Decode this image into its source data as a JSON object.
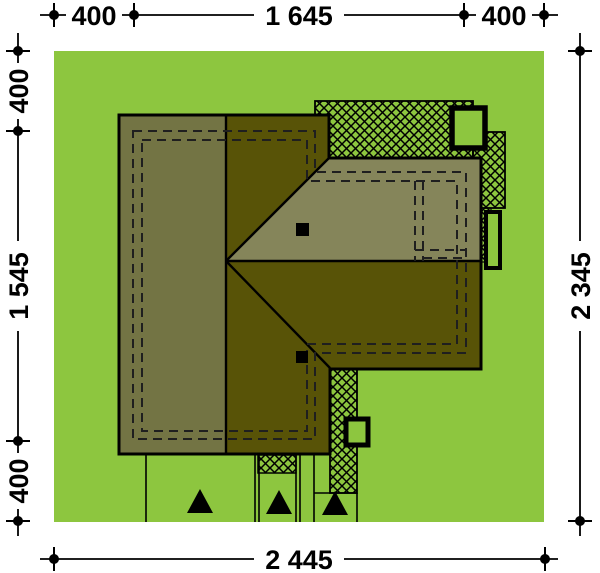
{
  "drawing": {
    "type": "house-site-plan",
    "dimensions": {
      "top": [
        "400",
        "1 645",
        "400"
      ],
      "left": [
        "400",
        "1 545",
        "400"
      ],
      "right": "2 345",
      "bottom": "2 445"
    },
    "colors": {
      "page": "#ffffff",
      "plot_green": "#8dc63f",
      "roof_left_plane": "#737444",
      "roof_north_plane": "#85855a",
      "roof_dark_plane": "#585307",
      "line_black": "#000000",
      "dash_gray": "#1f1f1f"
    },
    "features": {
      "terrace_hatch": "cross-hatched terrace/paving",
      "chimney": "black chimney square",
      "window_frame": "black framed opening",
      "entrance_marker": "black triangle entrance marker"
    }
  }
}
